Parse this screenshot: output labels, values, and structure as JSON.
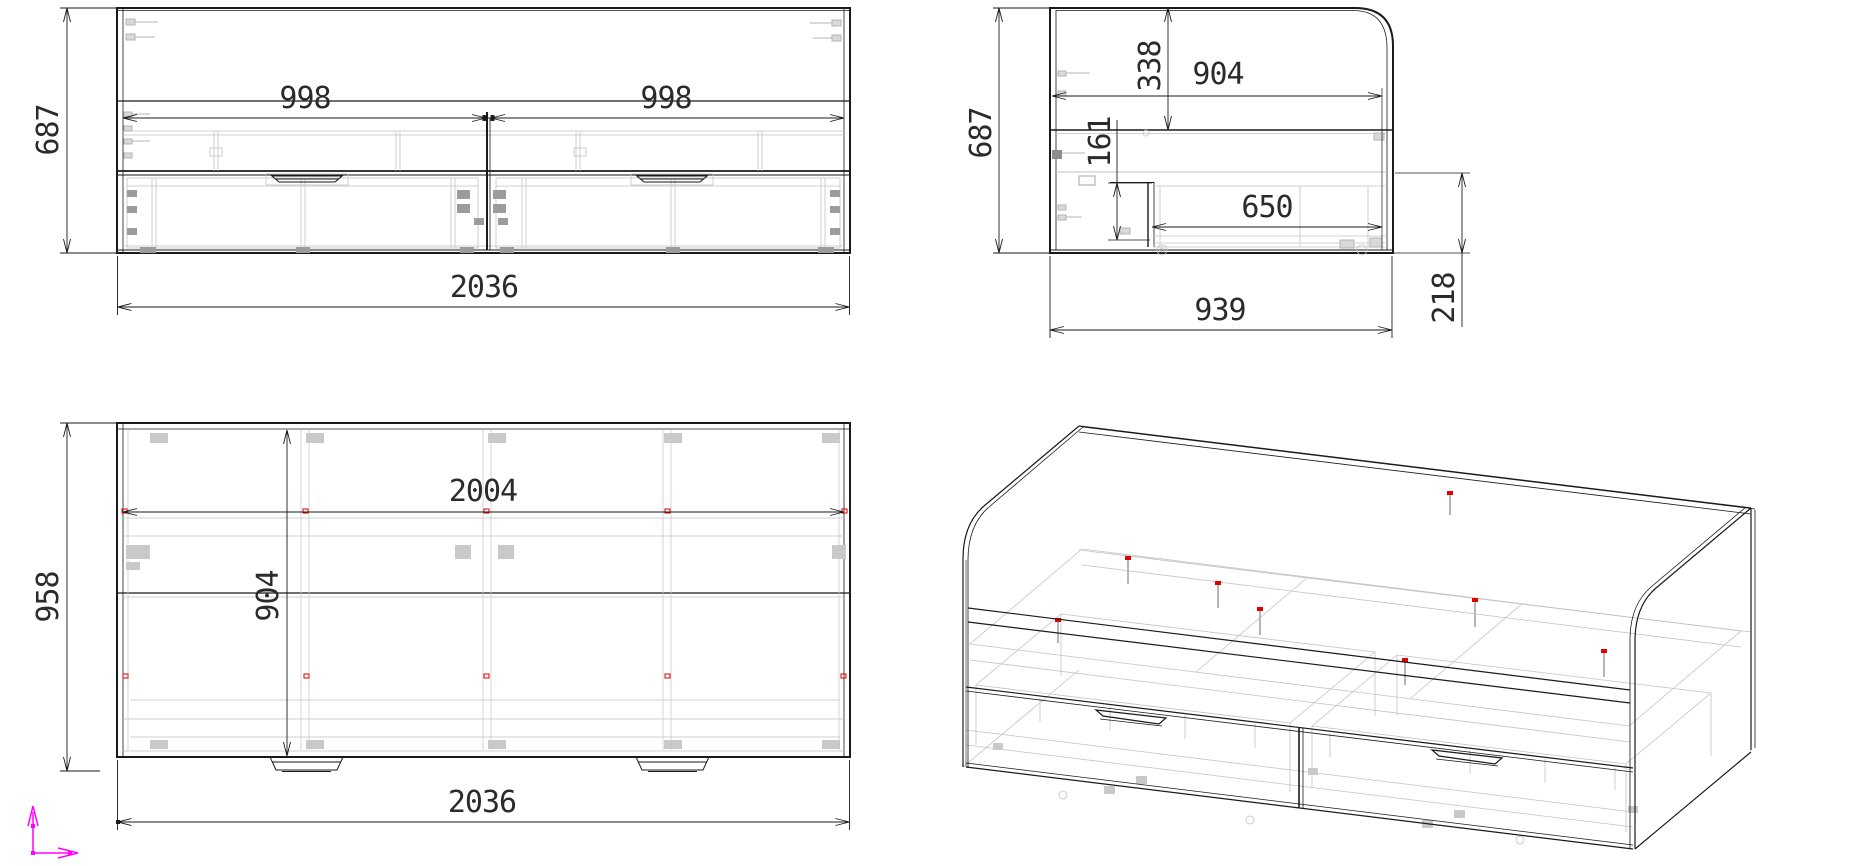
{
  "drawing": {
    "title": "bed-with-drawers-technical-drawing",
    "views": {
      "front": {
        "name": "front-elevation",
        "dims": {
          "overall_height": "687",
          "left_opening": "998",
          "right_opening": "998",
          "overall_width": "2036"
        }
      },
      "side": {
        "name": "side-elevation",
        "dims": {
          "overall_height": "687",
          "headboard_drop": "338",
          "top_depth": "904",
          "drawer_offset": "161",
          "drawer_length": "650",
          "base_depth": "939",
          "drawer_height": "218"
        }
      },
      "plan": {
        "name": "plan-view",
        "dims": {
          "overall_depth": "958",
          "inner_width": "2004",
          "inner_depth": "904",
          "overall_width": "2036"
        }
      },
      "iso": {
        "name": "isometric-view"
      }
    },
    "icons": [
      {
        "name": "ucs-axis-icon",
        "color": "#ff00ff"
      }
    ],
    "colors": {
      "line": "#1a1a1a",
      "detail_light": "#c3c3c3",
      "detail_mid": "#9c9c9c",
      "marker_red": "#e10000",
      "axis_magenta": "#ff00ff",
      "background": "#ffffff"
    }
  }
}
